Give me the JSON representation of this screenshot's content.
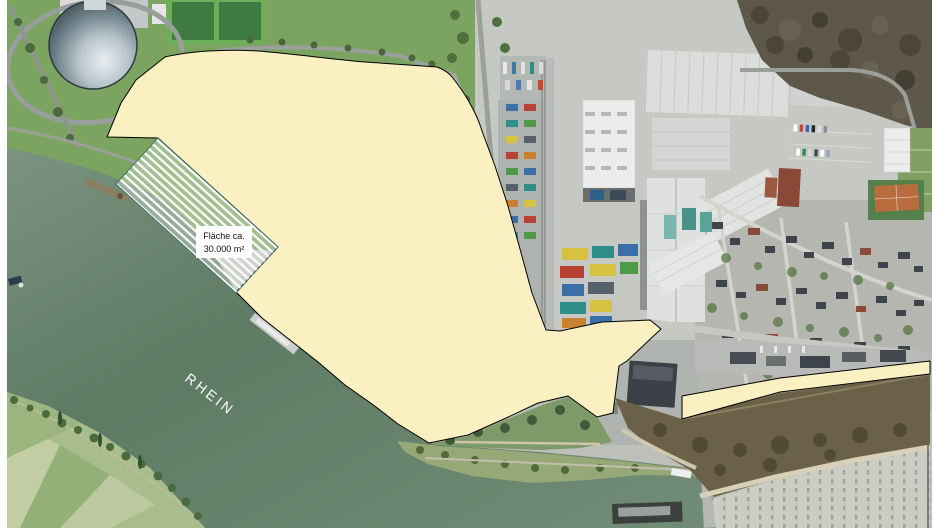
{
  "map": {
    "labels": {
      "river": "RHEIN",
      "area_line1": "Fläche ca.",
      "area_line2": "30.000 m²"
    },
    "colors": {
      "highlight_fill": "#faf0c2",
      "highlight_outline": "#000000",
      "hatch_stripe": "#ffffff",
      "hatch_outline": "#2f6b63",
      "water": "#5e7b64",
      "river_label_color": "#ffffff",
      "area_label_bg": "#ffffff",
      "area_label_text": "#111111",
      "page_margin": "#ffffff"
    }
  }
}
